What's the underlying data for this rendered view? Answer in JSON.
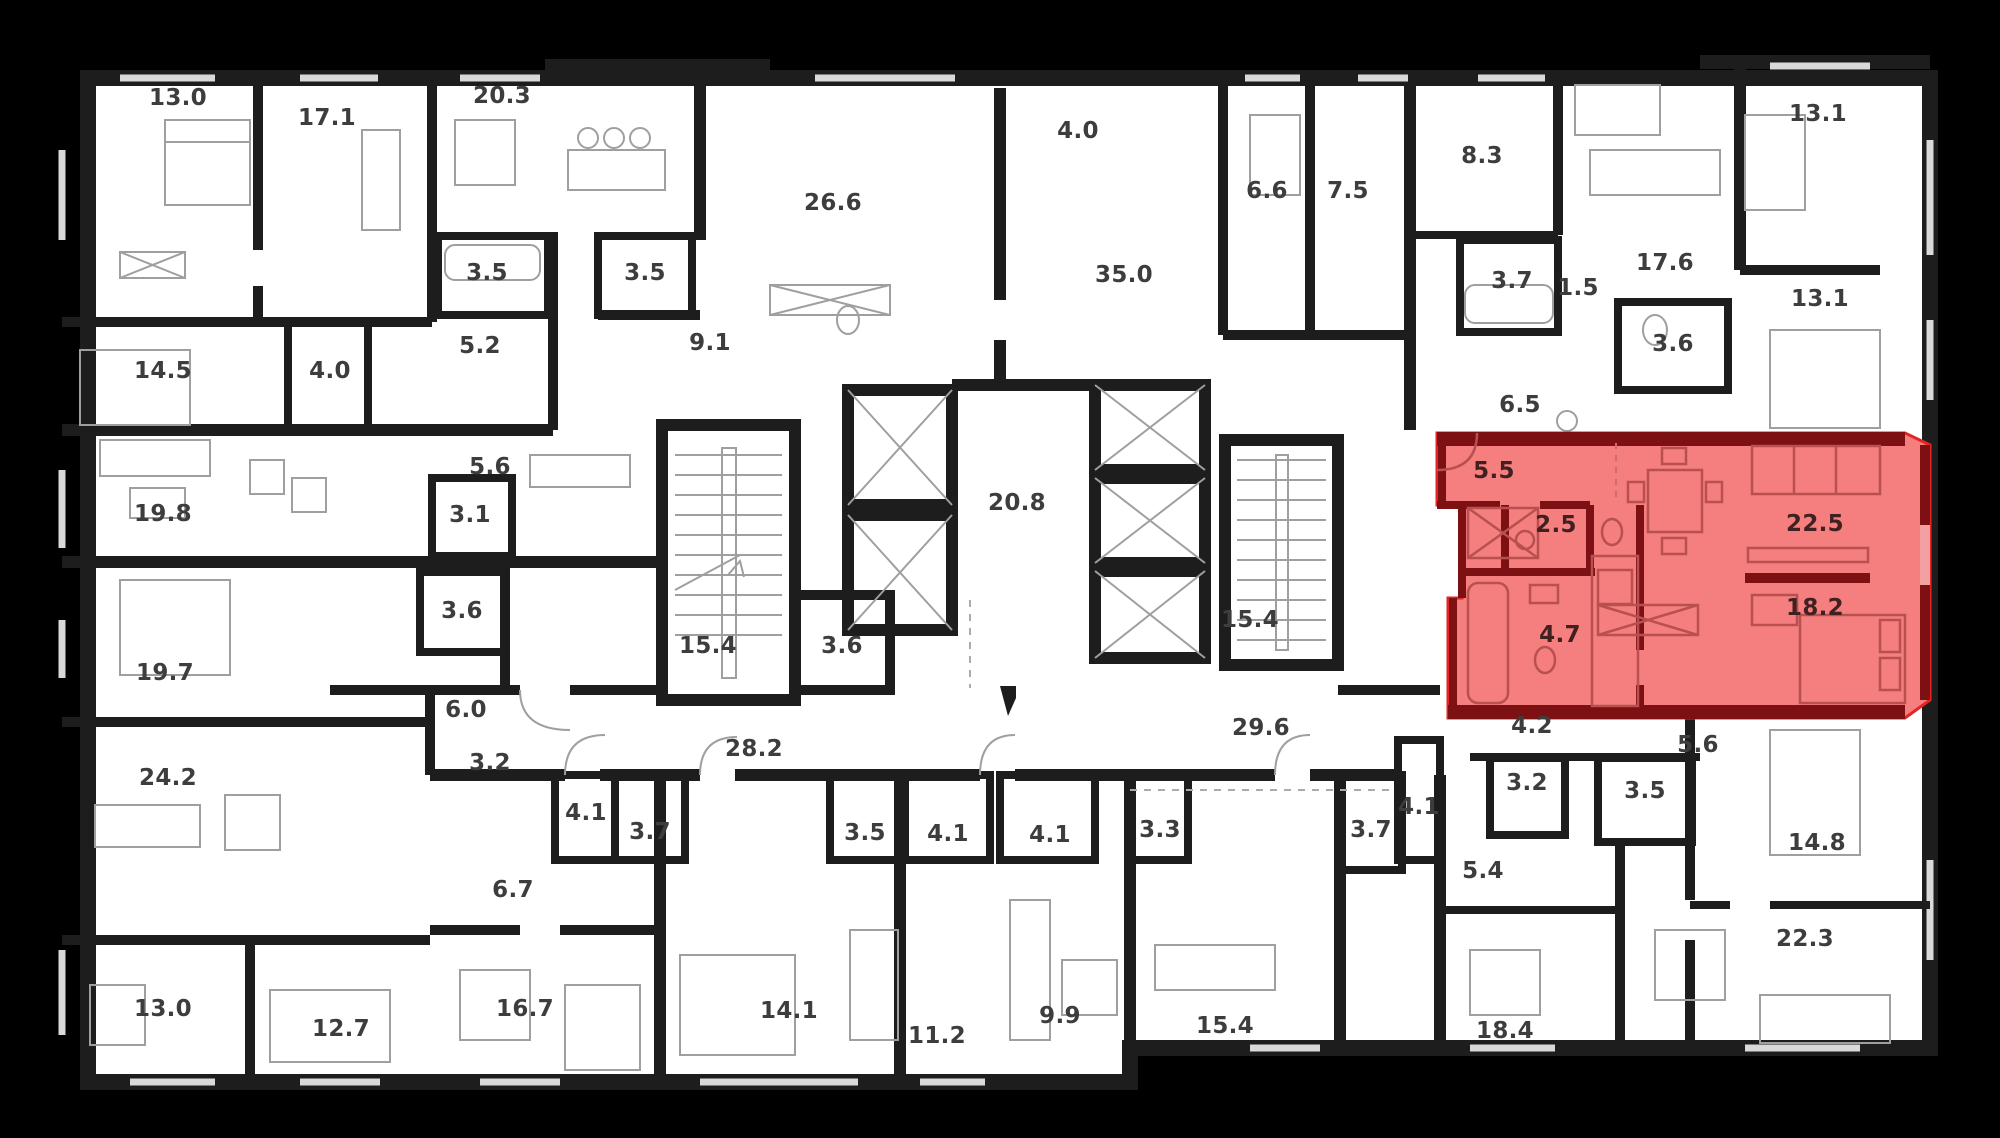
{
  "canvas": {
    "width": 2000,
    "height": 1138
  },
  "colors": {
    "background": "#000000",
    "plan_fill": "#ffffff",
    "wall": "#1d1d1d",
    "furniture_line": "#9f9f9f",
    "window_line": "#d9d9d9",
    "label_text": "#3d3d3d",
    "highlight_fill": "#f57e7e",
    "highlight_wall": "#7c1013",
    "highlight_outline": "#e32526",
    "highlight_label_text": "#402020"
  },
  "highlighted_apartment": {
    "room_areas": [
      "5.5",
      "2.5",
      "4.7",
      "22.5",
      "18.2"
    ]
  },
  "rooms": [
    {
      "area": "13.0",
      "x": 178,
      "y": 105,
      "highlighted": false
    },
    {
      "area": "17.1",
      "x": 327,
      "y": 125,
      "highlighted": false
    },
    {
      "area": "20.3",
      "x": 502,
      "y": 103,
      "highlighted": false
    },
    {
      "area": "26.6",
      "x": 833,
      "y": 210,
      "highlighted": false
    },
    {
      "area": "4.0",
      "x": 1078,
      "y": 138,
      "highlighted": false
    },
    {
      "area": "6.6",
      "x": 1267,
      "y": 198,
      "highlighted": false
    },
    {
      "area": "7.5",
      "x": 1348,
      "y": 198,
      "highlighted": false
    },
    {
      "area": "8.3",
      "x": 1482,
      "y": 163,
      "highlighted": false
    },
    {
      "area": "13.1",
      "x": 1818,
      "y": 121,
      "highlighted": false
    },
    {
      "area": "3.5",
      "x": 487,
      "y": 280,
      "highlighted": false
    },
    {
      "area": "3.5",
      "x": 645,
      "y": 280,
      "highlighted": false
    },
    {
      "area": "3.7",
      "x": 1512,
      "y": 288,
      "highlighted": false
    },
    {
      "area": "1.5",
      "x": 1578,
      "y": 295,
      "highlighted": false
    },
    {
      "area": "17.6",
      "x": 1665,
      "y": 270,
      "highlighted": false
    },
    {
      "area": "13.1",
      "x": 1820,
      "y": 306,
      "highlighted": false
    },
    {
      "area": "14.5",
      "x": 163,
      "y": 378,
      "highlighted": false
    },
    {
      "area": "4.0",
      "x": 330,
      "y": 378,
      "highlighted": false
    },
    {
      "area": "5.2",
      "x": 480,
      "y": 353,
      "highlighted": false
    },
    {
      "area": "9.1",
      "x": 710,
      "y": 350,
      "highlighted": false
    },
    {
      "area": "35.0",
      "x": 1124,
      "y": 282,
      "highlighted": false
    },
    {
      "area": "3.6",
      "x": 1673,
      "y": 351,
      "highlighted": false
    },
    {
      "area": "6.5",
      "x": 1520,
      "y": 412,
      "highlighted": false
    },
    {
      "area": "19.8",
      "x": 163,
      "y": 521,
      "highlighted": false
    },
    {
      "area": "5.6",
      "x": 490,
      "y": 474,
      "highlighted": false
    },
    {
      "area": "3.1",
      "x": 470,
      "y": 522,
      "highlighted": false
    },
    {
      "area": "20.8",
      "x": 1017,
      "y": 510,
      "highlighted": false
    },
    {
      "area": "5.5",
      "x": 1494,
      "y": 478,
      "highlighted": true
    },
    {
      "area": "2.5",
      "x": 1556,
      "y": 532,
      "highlighted": true
    },
    {
      "area": "22.5",
      "x": 1815,
      "y": 531,
      "highlighted": true
    },
    {
      "area": "15.4",
      "x": 708,
      "y": 653,
      "highlighted": false
    },
    {
      "area": "3.6",
      "x": 842,
      "y": 653,
      "highlighted": false
    },
    {
      "area": "15.4",
      "x": 1250,
      "y": 627,
      "highlighted": false
    },
    {
      "area": "18.2",
      "x": 1815,
      "y": 615,
      "highlighted": true
    },
    {
      "area": "4.7",
      "x": 1560,
      "y": 642,
      "highlighted": true
    },
    {
      "area": "3.6",
      "x": 462,
      "y": 618,
      "highlighted": false
    },
    {
      "area": "19.7",
      "x": 165,
      "y": 680,
      "highlighted": false
    },
    {
      "area": "6.0",
      "x": 466,
      "y": 717,
      "highlighted": false
    },
    {
      "area": "28.2",
      "x": 754,
      "y": 756,
      "highlighted": false
    },
    {
      "area": "29.6",
      "x": 1261,
      "y": 735,
      "highlighted": false
    },
    {
      "area": "4.2",
      "x": 1532,
      "y": 733,
      "highlighted": false
    },
    {
      "area": "5.6",
      "x": 1698,
      "y": 752,
      "highlighted": false
    },
    {
      "area": "24.2",
      "x": 168,
      "y": 785,
      "highlighted": false
    },
    {
      "area": "3.2",
      "x": 490,
      "y": 770,
      "highlighted": false
    },
    {
      "area": "4.1",
      "x": 586,
      "y": 820,
      "highlighted": false
    },
    {
      "area": "3.7",
      "x": 650,
      "y": 839,
      "highlighted": false
    },
    {
      "area": "3.5",
      "x": 865,
      "y": 840,
      "highlighted": false
    },
    {
      "area": "4.1",
      "x": 948,
      "y": 841,
      "highlighted": false
    },
    {
      "area": "4.1",
      "x": 1050,
      "y": 842,
      "highlighted": false
    },
    {
      "area": "3.3",
      "x": 1160,
      "y": 837,
      "highlighted": false
    },
    {
      "area": "3.7",
      "x": 1371,
      "y": 837,
      "highlighted": false
    },
    {
      "area": "4.1",
      "x": 1419,
      "y": 814,
      "highlighted": false
    },
    {
      "area": "3.2",
      "x": 1527,
      "y": 790,
      "highlighted": false
    },
    {
      "area": "3.5",
      "x": 1645,
      "y": 798,
      "highlighted": false
    },
    {
      "area": "6.7",
      "x": 513,
      "y": 897,
      "highlighted": false
    },
    {
      "area": "5.4",
      "x": 1483,
      "y": 878,
      "highlighted": false
    },
    {
      "area": "14.8",
      "x": 1817,
      "y": 850,
      "highlighted": false
    },
    {
      "area": "13.0",
      "x": 163,
      "y": 1016,
      "highlighted": false
    },
    {
      "area": "12.7",
      "x": 341,
      "y": 1036,
      "highlighted": false
    },
    {
      "area": "16.7",
      "x": 525,
      "y": 1016,
      "highlighted": false
    },
    {
      "area": "14.1",
      "x": 789,
      "y": 1018,
      "highlighted": false
    },
    {
      "area": "11.2",
      "x": 937,
      "y": 1043,
      "highlighted": false
    },
    {
      "area": "9.9",
      "x": 1060,
      "y": 1023,
      "highlighted": false
    },
    {
      "area": "15.4",
      "x": 1225,
      "y": 1033,
      "highlighted": false
    },
    {
      "area": "18.4",
      "x": 1505,
      "y": 1038,
      "highlighted": false
    },
    {
      "area": "22.3",
      "x": 1805,
      "y": 946,
      "highlighted": false
    }
  ]
}
